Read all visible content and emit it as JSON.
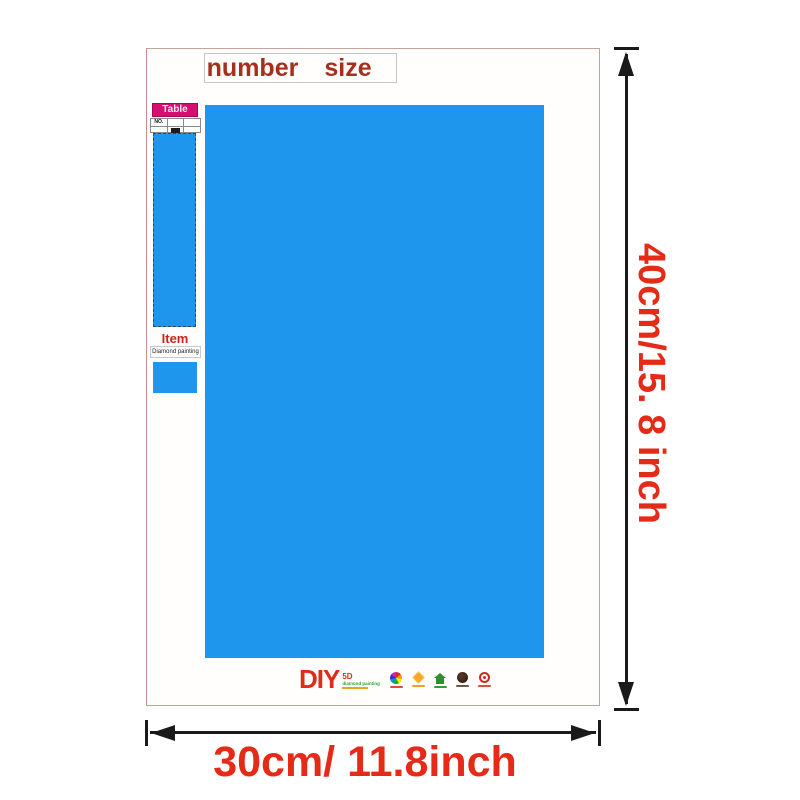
{
  "header": {
    "number_label": "number",
    "size_label": "size"
  },
  "sidebar": {
    "table_label": "Table",
    "table_no_header": "NO.",
    "item_label": "Item",
    "item_value": "Diamond painting"
  },
  "logo": {
    "diy": "DIY",
    "five_d": "5D",
    "subtitle": "diamond painting"
  },
  "dimensions": {
    "height_label": "40cm/15. 8 inch",
    "width_label": "30cm/ 11.8inch"
  },
  "colors": {
    "canvas_blue": "#1e96ee",
    "header_text_red": "#a5301e",
    "dimension_text_red": "#e52a18",
    "table_label_magenta": "#d40f6f",
    "item_label_red": "#c8241c",
    "logo_red": "#e02a1a",
    "logo_green": "#2f9e2f",
    "arrow_black": "#1a1a1a"
  }
}
